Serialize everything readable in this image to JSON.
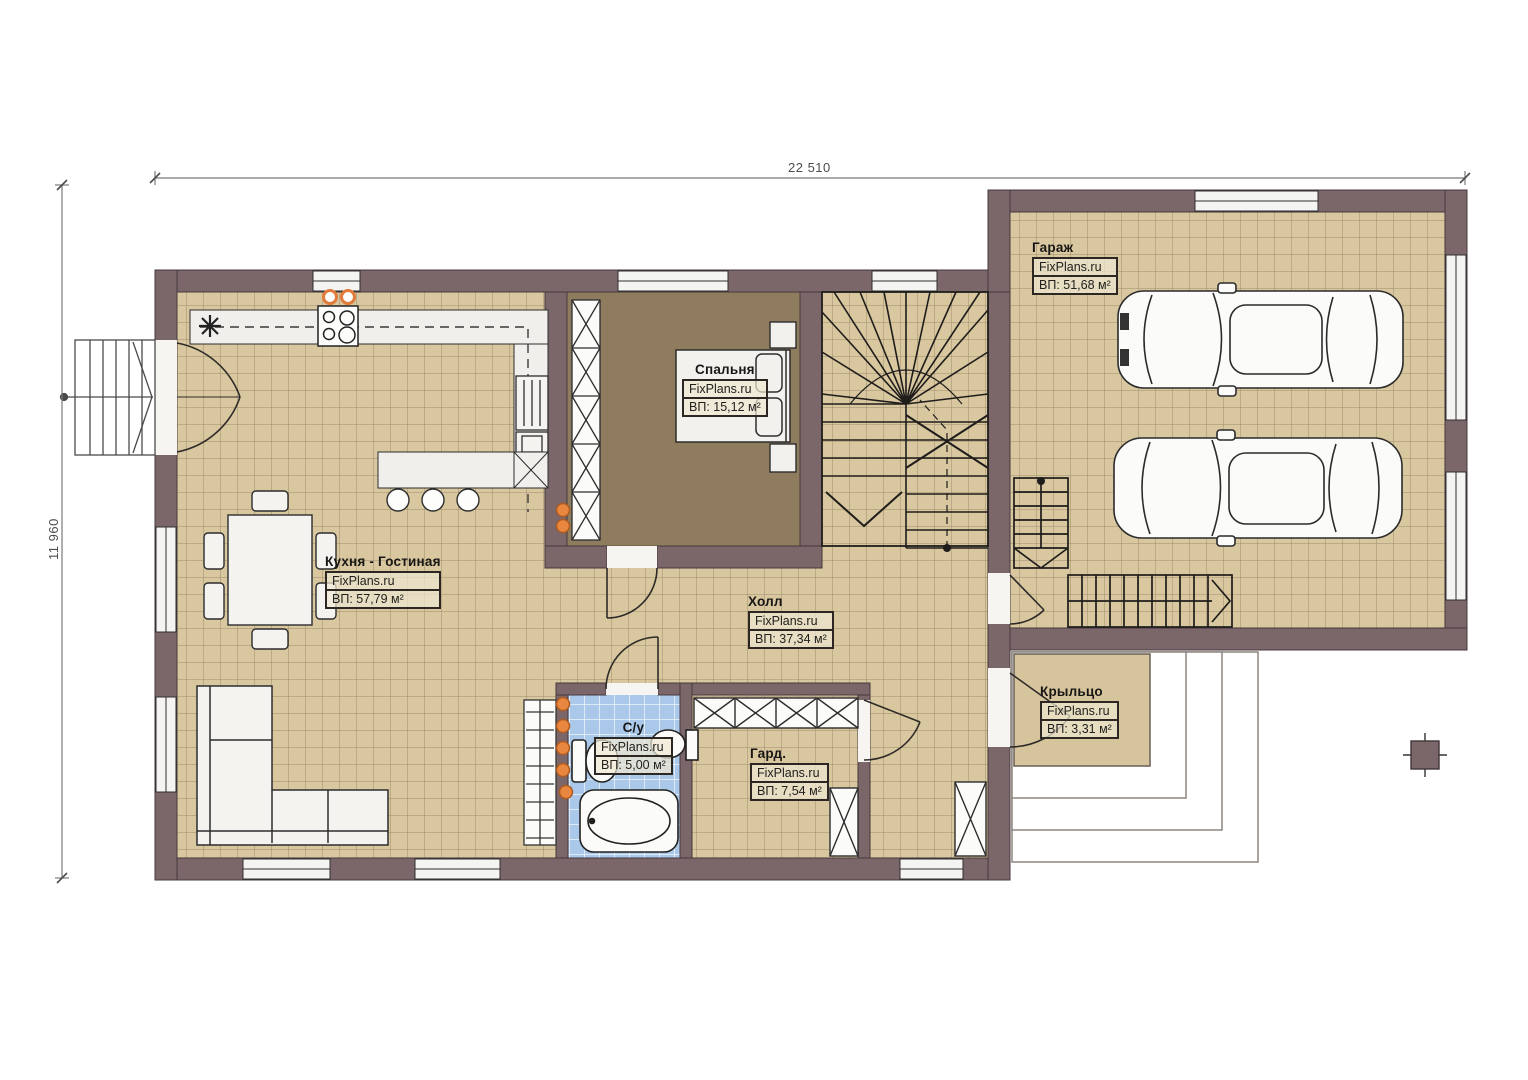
{
  "plan": {
    "brand": "FixPlans.ru",
    "dimensions": {
      "width_label": "22 510",
      "height_label": "11 960"
    },
    "rooms": {
      "kitchen_living": {
        "name": "Кухня - Гостиная",
        "brand": "FixPlans.ru",
        "area": "ВП: 57,79 м²"
      },
      "bedroom": {
        "name": "Спальня",
        "brand": "FixPlans.ru",
        "area": "ВП: 15,12 м²"
      },
      "hall": {
        "name": "Холл",
        "brand": "FixPlans.ru",
        "area": "ВП: 37,34 м²"
      },
      "bathroom": {
        "name": "С/у",
        "brand": "FixPlans.ru",
        "area": "ВП: 5,00 м²"
      },
      "wardrobe": {
        "name": "Гард.",
        "brand": "FixPlans.ru",
        "area": "ВП: 7,54 м²"
      },
      "garage": {
        "name": "Гараж",
        "brand": "FixPlans.ru",
        "area": "ВП: 51,68 м²"
      },
      "porch": {
        "name": "Крыльцо",
        "brand": "FixPlans.ru",
        "area": "ВП: 3,31 м²"
      }
    },
    "colors": {
      "wall": "#7b676a",
      "floor_tile": "#d8c79f",
      "bedroom_floor": "#8f7c5e",
      "bathroom_tile": "#aac9ea",
      "accent_orange": "#e07b3a"
    }
  }
}
